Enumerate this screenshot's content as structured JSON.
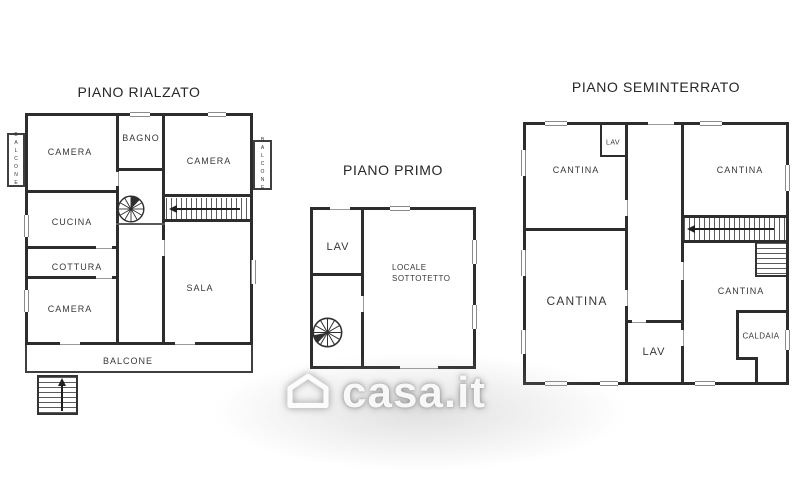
{
  "colors": {
    "wall": "#2d2d2d",
    "room_label": "#383838",
    "title": "#262626",
    "watermark_glow": "#b2b2b2"
  },
  "watermark": {
    "text": "casa.it",
    "icon": "house-icon"
  },
  "plans": {
    "rialzato": {
      "title": "PIANO RIALZATO",
      "labels": {
        "camera_nw": "CAMERA",
        "bagno": "BAGNO",
        "camera_ne": "CAMERA",
        "cucina": "CUCINA",
        "cottura": "COTTURA",
        "camera_sw": "CAMERA",
        "sala": "SALA",
        "balcone_bottom": "BALCONE",
        "balcone_left": "BALCONE",
        "balcone_right": "BALCONE"
      }
    },
    "primo": {
      "title": "PIANO PRIMO",
      "labels": {
        "lav": "LAV",
        "locale_sottotetto": "LOCALE SOTTOTETTO"
      }
    },
    "seminterrato": {
      "title": "PIANO SEMINTERRATO",
      "labels": {
        "lav_top": "LAV",
        "cantina_nw": "CANTINA",
        "cantina_ne": "CANTINA",
        "cantina_sw": "CANTINA",
        "cantina_se": "CANTINA",
        "lav_bottom": "LAV",
        "caldaia": "CALDAIA"
      }
    }
  }
}
